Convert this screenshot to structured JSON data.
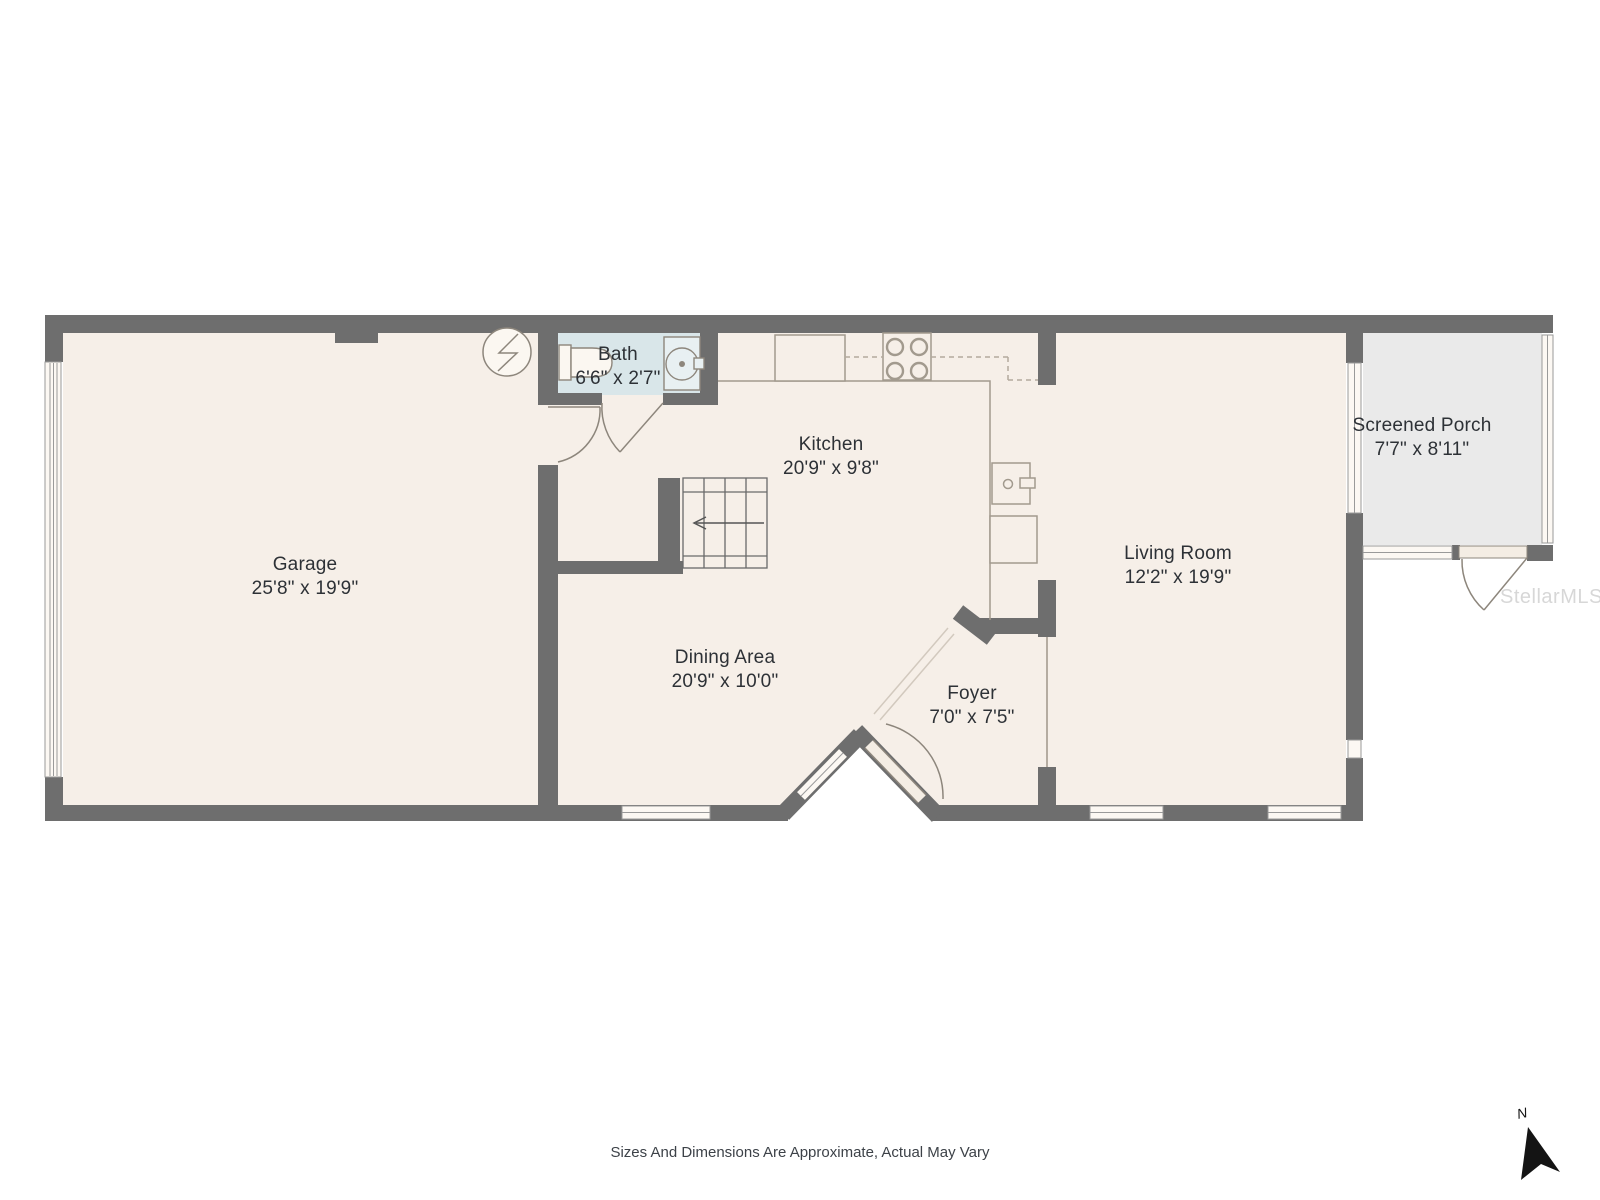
{
  "title": "Floor plan",
  "rooms": [
    {
      "id": "garage",
      "name": "Garage",
      "dims": "25'8\" x 19'9\""
    },
    {
      "id": "bath",
      "name": "Bath",
      "dims": "6'6\" x 2'7\""
    },
    {
      "id": "kitchen",
      "name": "Kitchen",
      "dims": "20'9\" x 9'8\""
    },
    {
      "id": "dining",
      "name": "Dining Area",
      "dims": "20'9\" x 10'0\""
    },
    {
      "id": "foyer",
      "name": "Foyer",
      "dims": "7'0\" x 7'5\""
    },
    {
      "id": "living",
      "name": "Living Room",
      "dims": "12'2\" x 19'9\""
    },
    {
      "id": "porch",
      "name": "Screened Porch",
      "dims": "7'7\" x 8'11\""
    }
  ],
  "footer": {
    "disclaimer": "Sizes And Dimensions Are Approximate, Actual May Vary"
  },
  "watermark": "StellarMLS",
  "compass": {
    "label": "N"
  },
  "colors": {
    "wall": "#6e6e6e",
    "floor": "#f6efe8",
    "bath_floor": "#d9e6e9",
    "porch_floor": "#eaeaea",
    "fixture_line": "#8d867c",
    "counter_line": "#a29a8e",
    "window_band": "#fcf8f3",
    "label_text": "#2d3136"
  }
}
